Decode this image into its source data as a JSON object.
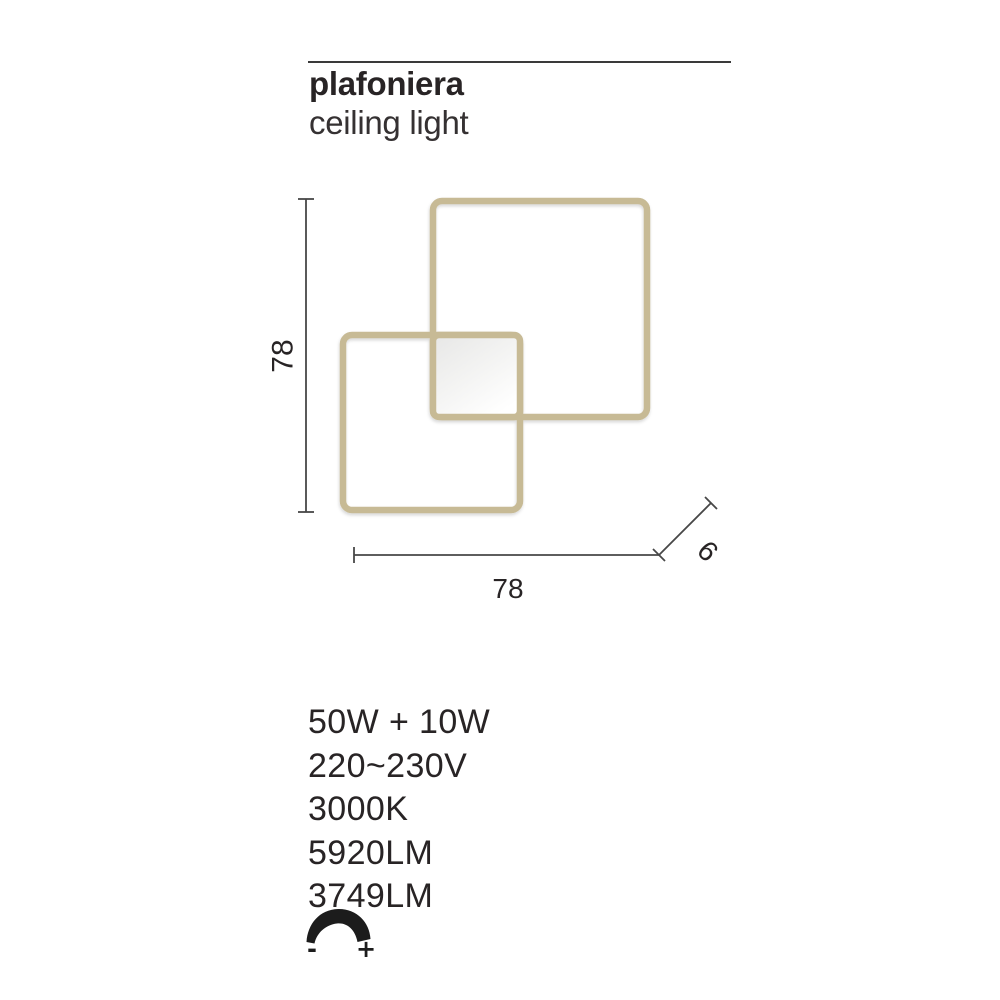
{
  "header": {
    "title": "plafoniera",
    "subtitle": "ceiling light"
  },
  "diagram": {
    "type": "technical-drawing",
    "frame_color": "#c7ba95",
    "line_color": "#474747",
    "panel_fill_top": "#e7e7e6",
    "panel_fill_bottom": "#ffffff",
    "dimensions": {
      "height": "78",
      "width": "78",
      "depth": "9"
    },
    "shapes": [
      "outer-square-frame",
      "inner-square-frame",
      "central-led-panel"
    ]
  },
  "specs": {
    "items": [
      "50W + 10W",
      "220~230V",
      "3000K",
      "5920LM",
      "3749LM"
    ]
  },
  "dimmer": {
    "icon": "dimmer-arc-icon",
    "minus": "-",
    "plus": "+"
  },
  "colors": {
    "text": "#282425",
    "rule": "#3a3a3a",
    "icon_black": "#1c1c1c"
  }
}
